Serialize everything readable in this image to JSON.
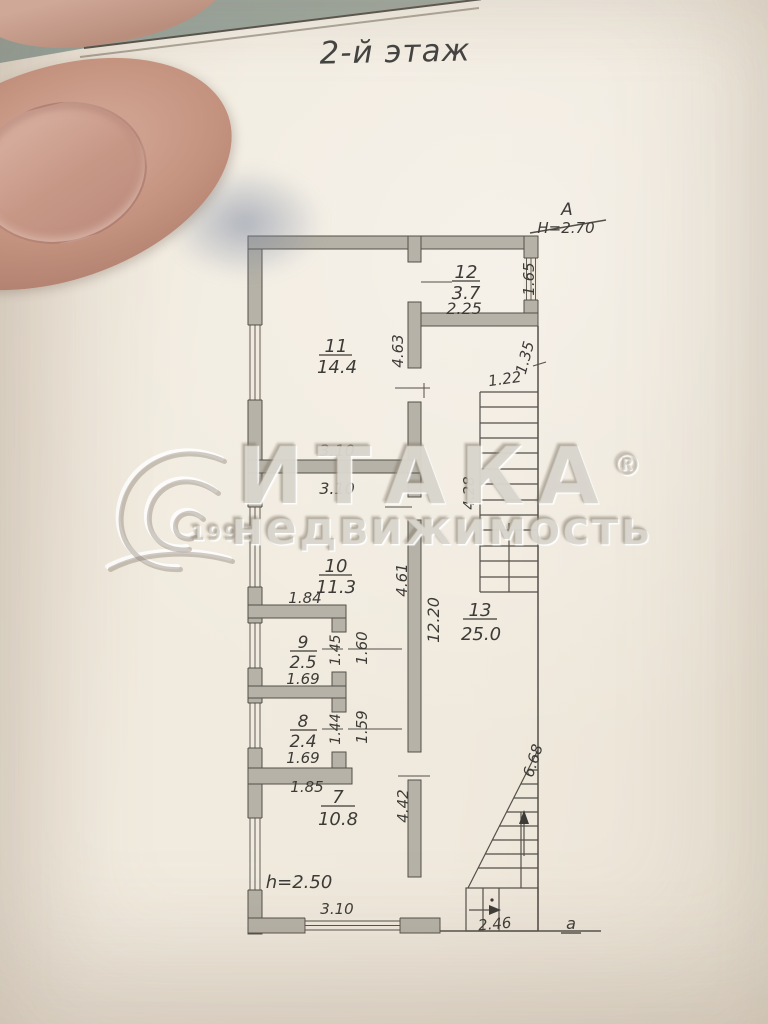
{
  "photo": {
    "title": "2-й этаж",
    "paper_color": "#f0e9dd",
    "background_color": "#98a29a",
    "ink_color": "#3d3b37",
    "wall_fill": "#b6b2a7"
  },
  "watermark": {
    "brand": "ИТАКА",
    "registered": "®",
    "subtitle": "недвижимость",
    "year": "1993"
  },
  "plan": {
    "axis_top_letter": "А",
    "axis_top_height": "Н=2.70",
    "axis_bottom_letter": "а",
    "ceiling_height": "h=2.50",
    "rooms": [
      {
        "number": "12",
        "area": "3.7"
      },
      {
        "number": "11",
        "area": "14.4"
      },
      {
        "number": "10",
        "area": "11.3"
      },
      {
        "number": "9",
        "area": "2.5"
      },
      {
        "number": "8",
        "area": "2.4"
      },
      {
        "number": "7",
        "area": "10.8"
      },
      {
        "number": "13",
        "area": "25.0"
      }
    ],
    "dims": {
      "room12_window": "1.65",
      "room12_width": "2.25",
      "room11_right": "4.63",
      "room11_width": "3.10",
      "room10_top": "3.10",
      "room10_left": "1.84",
      "room10_right": "4.61",
      "hall_length": "12.20",
      "stair_width": "1.22",
      "stair_offset": "1.35",
      "stair_length": "4.28",
      "room9_inner": "1.45",
      "room9_outer": "1.60",
      "room9_width": "1.69",
      "room8_inner": "1.44",
      "room8_outer": "1.59",
      "room8_width": "1.69",
      "room7_top": "1.85",
      "room7_right": "4.42",
      "room7_width": "3.10",
      "stair2_length": "6.68",
      "stair2_width": "2.46"
    }
  }
}
